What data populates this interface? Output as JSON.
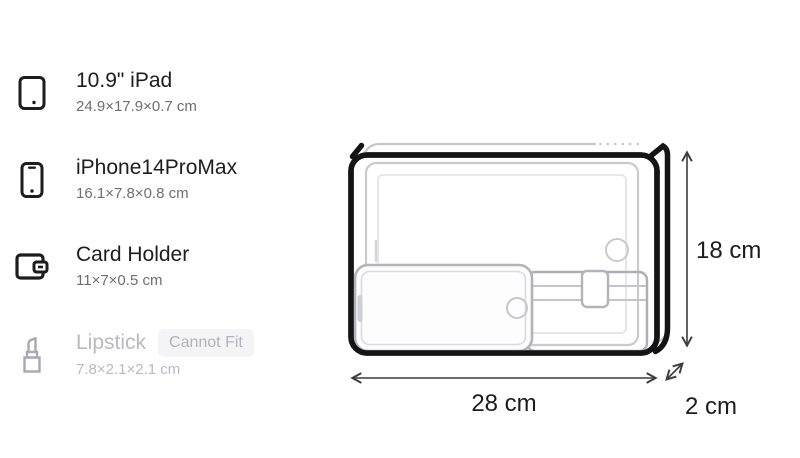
{
  "items": [
    {
      "title": "10.9\" iPad",
      "dims": "24.9×17.9×0.7 cm",
      "fits": true
    },
    {
      "title": "iPhone14ProMax",
      "dims": "16.1×7.8×0.8 cm",
      "fits": true
    },
    {
      "title": "Card Holder",
      "dims": "11×7×0.5 cm",
      "fits": true
    },
    {
      "title": "Lipstick",
      "dims": "7.8×2.1×2.1 cm",
      "fits": false,
      "badge": "Cannot Fit"
    }
  ],
  "bag": {
    "width_label": "28 cm",
    "height_label": "18 cm",
    "depth_label": "2 cm"
  },
  "colors": {
    "ink": "#1d1d1f",
    "subtext": "#6e6e73",
    "disabled_text": "#b9b9c1",
    "badge_bg": "#f4f4f6",
    "badge_text": "#b2b2ba",
    "bag_outline": "#141414",
    "item_outline_light": "#c9c9cf",
    "item_outline_mid": "#b3b3bc",
    "arrow": "#3c3c3e"
  }
}
